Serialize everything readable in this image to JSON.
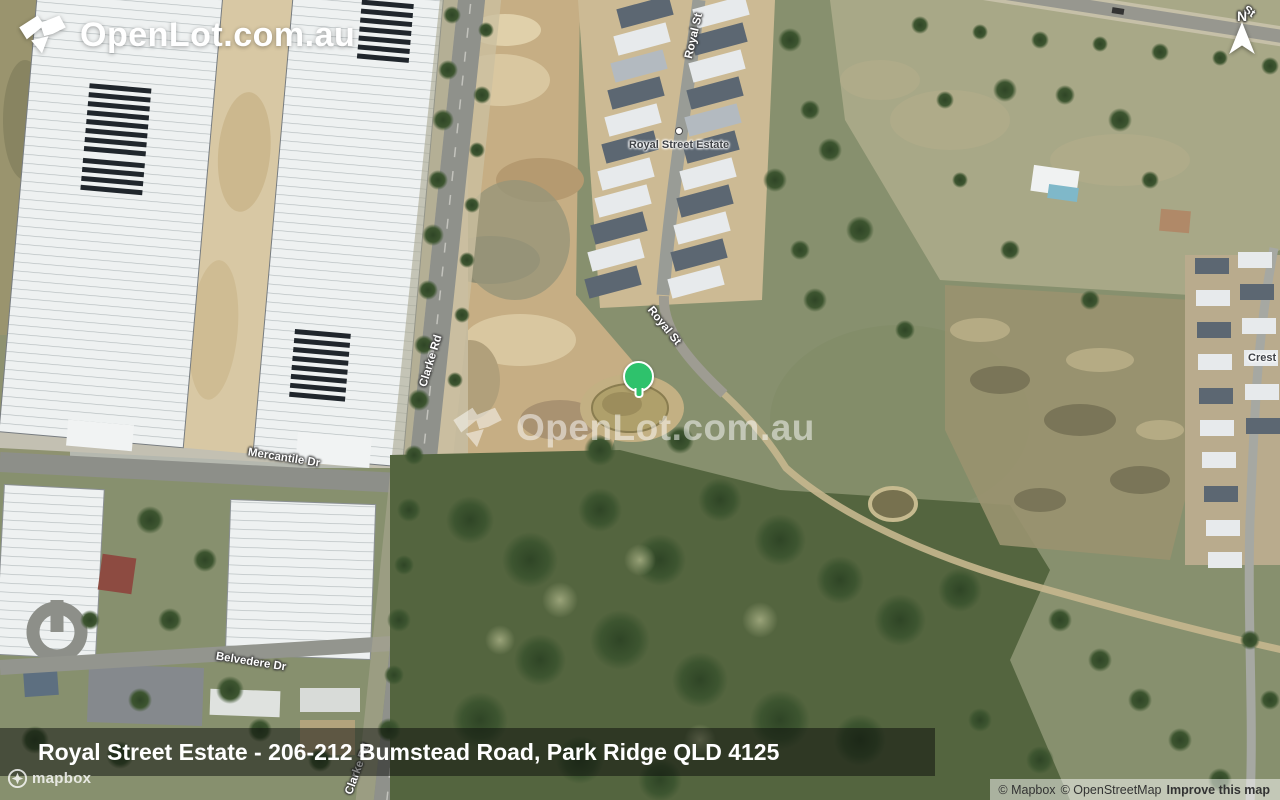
{
  "brand": {
    "logo_text": "OpenLot.com.au",
    "watermark_text": "OpenLot.com.au"
  },
  "compass": {
    "north_label": "N"
  },
  "marker": {
    "color": "#2ec26c"
  },
  "map_labels": {
    "royal_st": "Royal St",
    "clarke_rd": "Clarke Rd",
    "mercantile_dr": "Mercantile Dr",
    "belvedere_dr": "Belvedere Dr",
    "estate_poi": "Royal Street Estate",
    "crest_partial": "Crest",
    "top_right_street_partial": "St"
  },
  "address_bar": {
    "text": "Royal Street Estate - 206-212 Bumstead Road, Park Ridge QLD 4125"
  },
  "attribution": {
    "mapbox_copyright": "© Mapbox",
    "osm_copyright": "© OpenStreetMap",
    "improve_link": "Improve this map",
    "mapbox_wordmark": "mapbox"
  },
  "colors": {
    "marker_green": "#2ec26c",
    "address_overlay": "rgba(10,12,10,0.5)",
    "bushland_green": "#54653f",
    "dirt_tan": "#c6ae84"
  }
}
